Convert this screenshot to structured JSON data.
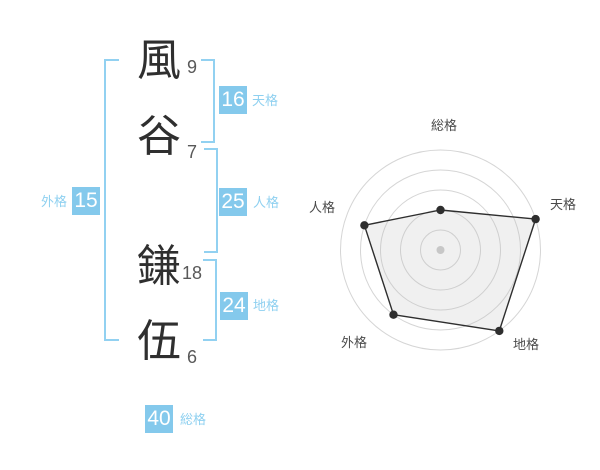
{
  "name": {
    "characters": [
      {
        "char": "風",
        "strokes": "9"
      },
      {
        "char": "谷",
        "strokes": "7"
      },
      {
        "char": "鎌",
        "strokes": "18"
      },
      {
        "char": "伍",
        "strokes": "6"
      }
    ]
  },
  "kaku": {
    "tenkaku": {
      "label": "天格",
      "value": "16"
    },
    "jinkaku": {
      "label": "人格",
      "value": "25"
    },
    "chikaku": {
      "label": "地格",
      "value": "24"
    },
    "gaikaku": {
      "label": "外格",
      "value": "15"
    },
    "soukaku": {
      "label": "総格",
      "value": "40"
    }
  },
  "colors": {
    "accent_blue": "#84C9EC",
    "bracket_blue": "#92D1F1",
    "label_blue": "#8ED0F0",
    "badge_text": "#FFFFFF",
    "kanji_dark": "#2F2F2F",
    "stroke_gray": "#595959",
    "radar_grid": "#D5D5D5",
    "radar_line": "#2E2E2E",
    "radar_fill": "rgba(187,187,187,0.22)",
    "radar_center_dot": "#C7C7C7",
    "radar_label": "#4A4A4A"
  },
  "chart_data": {
    "type": "radar",
    "title": "",
    "axes": [
      "総格",
      "天格",
      "地格",
      "外格",
      "人格"
    ],
    "values": [
      2,
      5,
      5,
      4,
      4
    ],
    "value_max": 5,
    "rings": 5,
    "start_angle_deg": -90,
    "clockwise": true,
    "grid_shape": "concentric-circles",
    "show_spokes": false,
    "legend": false,
    "label_positions": [
      {
        "x": 144,
        "y": 20
      },
      {
        "x": 263,
        "y": 99
      },
      {
        "x": 226,
        "y": 239
      },
      {
        "x": 54,
        "y": 237
      },
      {
        "x": 22,
        "y": 102
      }
    ]
  }
}
